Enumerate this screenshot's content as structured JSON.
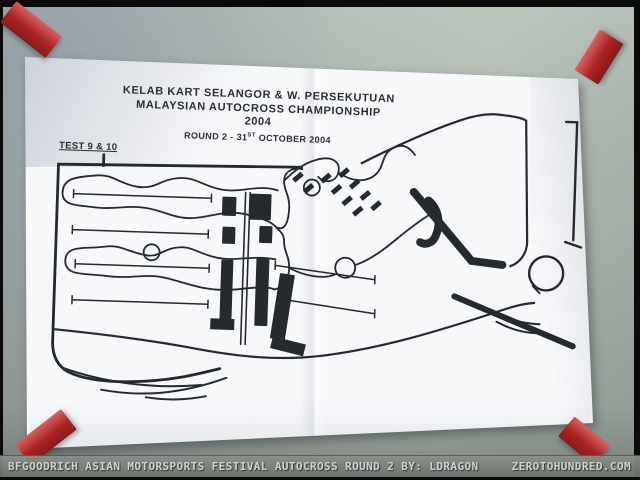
{
  "photo": {
    "description": "Photograph of a paper track map taped to a wall",
    "wall_color": "#aab4ae",
    "frame_color": "#0b0b0b",
    "tape_color": "#c32727",
    "paper_color": "#f7f8fa",
    "ink_color": "#26292e"
  },
  "poster": {
    "header": {
      "line1": "KELAB KART SELANGOR & W. PERSEKUTUAN",
      "line2": "MALAYSIAN AUTOCROSS CHAMPIONSHIP",
      "line3": "2004",
      "round_prefix": "ROUND 2 - 31",
      "round_superscript": "ST",
      "round_suffix": " OCTOBER 2004"
    },
    "test_label": "TEST 9 & 10"
  },
  "banner": {
    "left_text": "BFGOODRICH ASIAN MOTORSPORTS FESTIVAL AUTOCROSS ROUND 2 BY: LDRAGON",
    "right_text": "ZEROTOHUNDRED.COM",
    "bg_color": "#7c817c",
    "text_color": "#d3d7d3"
  }
}
